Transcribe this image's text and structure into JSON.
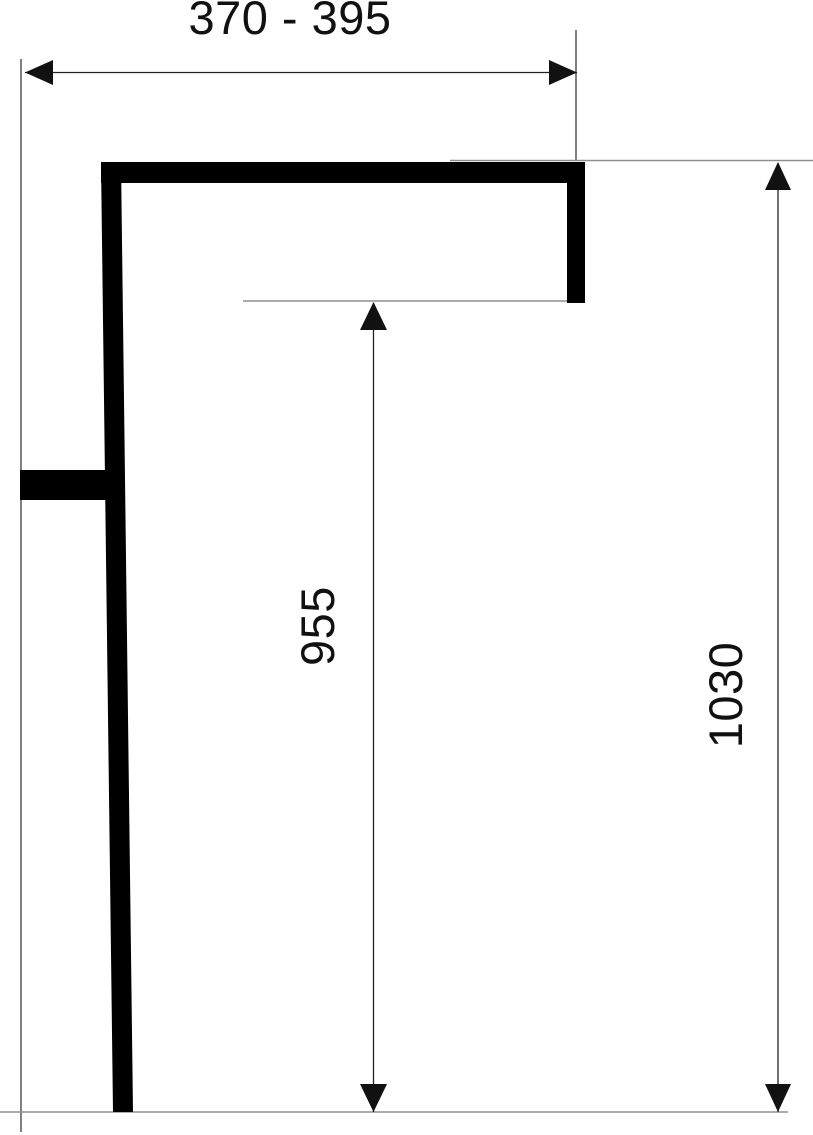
{
  "drawing": {
    "type": "technical-dimension-drawing",
    "labels": {
      "width_range": "370 - 395",
      "height_inner": "955",
      "height_overall": "1030"
    },
    "colors": {
      "shape": "#000000",
      "dimension_line": "#222222",
      "extension_line": "#8f8f8f",
      "extension_line_dark": "#3a3a3a",
      "text": "#111111",
      "background": "#ffffff"
    }
  }
}
